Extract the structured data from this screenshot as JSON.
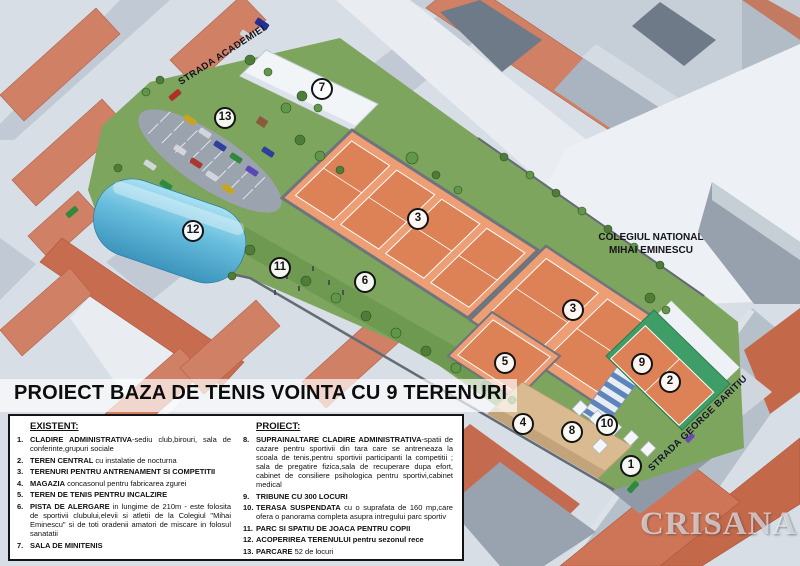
{
  "title": "PROIECT BAZA DE TENIS VOINTA CU 9 TERENURI",
  "watermark": "CRISANA",
  "map": {
    "street_academiei": "STRADA ACADEMIEI",
    "street_baritiu": "STRADA GEORGE BARITIU",
    "college": {
      "line1": "COLEGIUL NATIONAL",
      "line2": "MIHAI EMINESCU"
    },
    "markers": [
      {
        "label": "1"
      },
      {
        "label": "2"
      },
      {
        "label": "3"
      },
      {
        "label": "3"
      },
      {
        "label": "4"
      },
      {
        "label": "5"
      },
      {
        "label": "6"
      },
      {
        "label": "7"
      },
      {
        "label": "8"
      },
      {
        "label": "9"
      },
      {
        "label": "10"
      },
      {
        "label": "11"
      },
      {
        "label": "12"
      },
      {
        "label": "13"
      }
    ]
  },
  "legend": {
    "existent": {
      "header": "EXISTENT:",
      "items": [
        {
          "num": "1.",
          "bold": "CLADIRE ADMINISTRATIVA",
          "rest": "-sediu club,birouri, sala de conferinte,grupuri sociale"
        },
        {
          "num": "2.",
          "bold": "TEREN CENTRAL",
          "rest": " cu instalatie de nocturna"
        },
        {
          "num": "3.",
          "bold": "TERENURI PENTRU ANTRENAMENT SI COMPETITII",
          "rest": ""
        },
        {
          "num": "4.",
          "bold": "MAGAZIA",
          "rest": " concasonul pentru fabricarea zgurei"
        },
        {
          "num": "5.",
          "bold": "TEREN DE TENIS PENTRU INCALZIRE",
          "rest": ""
        },
        {
          "num": "6.",
          "bold": "PISTA DE ALERGARE",
          "rest": " in lungime de 210m - este folosita de sportivii clubului,elevii si atletii de la Colegiul \"Mihai Eminescu\" si de toti oradenii amatori de miscare in folosul sanatatii"
        },
        {
          "num": "7.",
          "bold": "SALA DE MINITENIS",
          "rest": ""
        }
      ]
    },
    "proiect": {
      "header": "PROIECT:",
      "items": [
        {
          "num": "8.",
          "bold": "SUPRAINALTARE CLADIRE ADMINISTRATIVA",
          "rest": "-spatii de cazare pentru sportivii din tara care se antreneaza la scoala de tenis,pentru sportivii participanti la competitii ; sala de pregatire fizica,sala de recuperare dupa efort, cabinet de consiliere psihologica pentru sportivi,cabinet medical"
        },
        {
          "num": "9.",
          "bold": "TRIBUNE CU 300 LOCURI",
          "rest": ""
        },
        {
          "num": "10.",
          "bold": "TERASA SUSPENDATA",
          "rest": " cu o suprafata de 160 mp,care ofera o panorama completa asupra intregului parc sportiv"
        },
        {
          "num": "11.",
          "bold": "PARC SI SPATIU DE JOACA PENTRU COPII",
          "rest": ""
        },
        {
          "num": "12.",
          "bold": "ACOPERIREA TERENULUI pentru sezonul rece",
          "rest": ""
        },
        {
          "num": "13.",
          "bold": "PARCARE",
          "rest": " 52 de locuri"
        }
      ]
    }
  },
  "palette": {
    "clay_court": "#dd8157",
    "court_margin": "#ee9e74",
    "grass": "#7da55d",
    "dome_blue": "#5fb6d9",
    "roof_salmon": "#cf8065",
    "roof_red": "#c4684a",
    "street": "#c0c9d4",
    "tribune_blue": "#5d84bb",
    "center_court_green": "#3f9e68",
    "admin_building_tan": "#dabb91"
  }
}
